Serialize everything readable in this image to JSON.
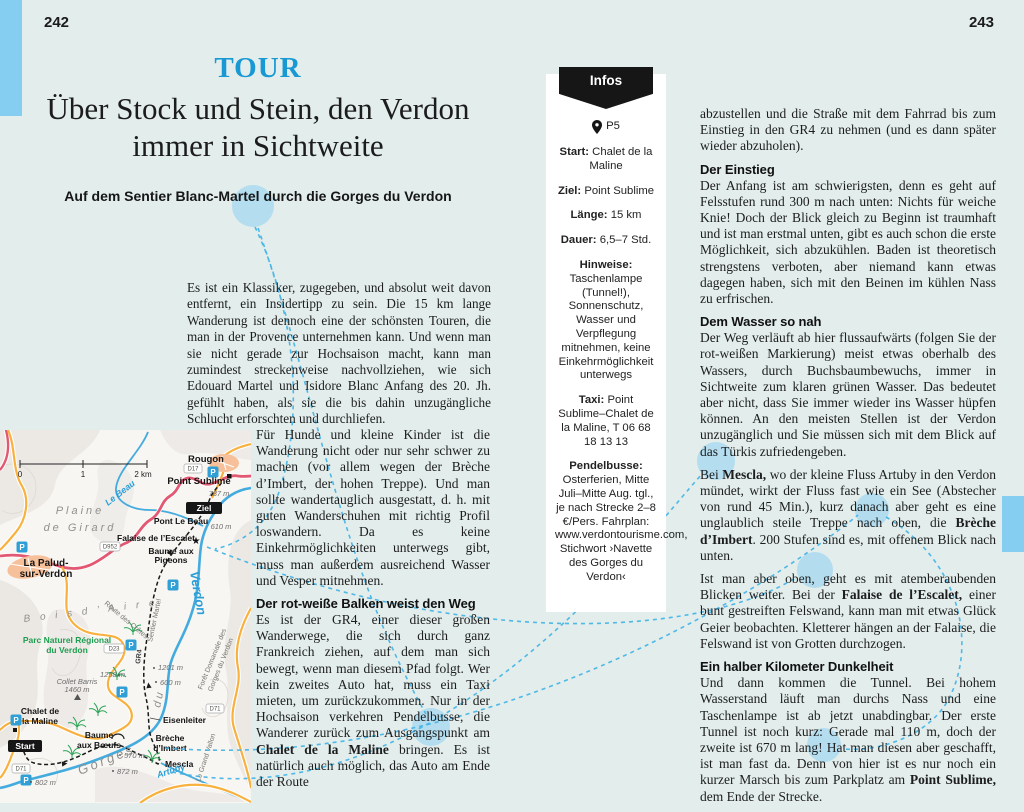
{
  "page": {
    "left_number": "242",
    "right_number": "243"
  },
  "colors": {
    "accent_blue": "#1899d4",
    "edge_bar_blue": "#85cef2",
    "highlight_blue": "#8ed0f2",
    "connector_blue": "#3fb3e6",
    "road_red": "#e25872",
    "road_yellow": "#f8b13f",
    "river_blue": "#44abde",
    "park_green": "#1e9e50",
    "village_orange": "#f6c09a"
  },
  "header": {
    "kicker": "TOUR",
    "title_line1": "Über Stock und Stein, den Verdon",
    "title_line2": "immer in Sichtweite",
    "subtitle": "Auf dem Sentier Blanc-Martel durch die Gorges du Verdon"
  },
  "left_column": {
    "para1": "Es ist ein Klassiker, zugegeben, und absolut weit davon entfernt, ein Insidertipp zu sein. Die 15 km lange Wanderung ist dennoch eine der schönsten Touren, die man in der Provence unternehmen kann. Und wenn man sie nicht gerade zur Hochsaison macht, kann man zumindest streckenweise nachvollziehen, wie sich Edouard Martel und Isidore Blanc Anfang des 20. Jh. gefühlt haben, als sie die bis dahin unzugängliche Schlucht erforschten und durchliefen.",
    "para2": "Für Hunde und kleine Kinder ist die Wanderung nicht oder nur sehr schwer zu machen (vor allem wegen der Brèche d’Imbert, der hohen Treppe). Und man sollte wandertauglich ausgestatt, d. h. mit guten Wanderschuhen mit richtig Profil loswandern. Da es keine Einkehrmöglichkeiten unterwegs gibt, muss man außerdem ausreichend Wasser und Vesper mitnehmen.",
    "heading1": "Der rot-weiße Balken weist den Weg",
    "para3_rich": [
      {
        "t": "Es ist der GR4, einer dieser großen Wanderwege, die sich durch ganz Frankreich ziehen, auf dem man sich bewegt, wenn man diesem Pfad folgt. Wer kein zweites Auto hat, muss ein Taxi mieten, um zurückzukommen. Nur in der Hochsaison verkehren Pendelbusse, die Wanderer zurück zum Ausgangspunkt am "
      },
      {
        "t": "Chalet de la Maline",
        "b": true
      },
      {
        "t": " bringen. Es ist natürlich auch möglich, das Auto am Ende der Route"
      }
    ]
  },
  "right_column": {
    "para0": "abzustellen und die Straße mit dem Fahrrad bis zum Einstieg in den GR4 zu nehmen (und es dann später wieder abzuholen).",
    "h1": "Der Einstieg",
    "p1": "Der Anfang ist am schwierigsten, denn es geht auf Felsstufen rund 300 m nach unten: Nichts für weiche Knie! Doch der Blick gleich zu Beginn ist traumhaft und ist man erstmal unten, gibt es auch schon die erste Möglichkeit, sich abzukühlen. Baden ist theoretisch strengstens verboten, aber niemand kann etwas dagegen haben, sich mit den Beinen im kühlen Nass zu erfrischen.",
    "h2": "Dem Wasser so nah",
    "p2": "Der Weg verläuft ab hier flussaufwärts (folgen Sie der rot-weißen Markierung) meist etwas oberhalb des Wassers, durch Buchsbaumbewuchs, immer in Sichtweite zum klaren grünen Wasser. Das bedeutet aber nicht, dass Sie immer wieder ins Wasser hüpfen können. An den meisten Stellen ist der Verdon unzugänglich und Sie müssen sich mit dem Blick auf das Türkis zufriedengeben.",
    "p3_rich": [
      {
        "t": "Bei "
      },
      {
        "t": "Mescla,",
        "b": true
      },
      {
        "t": " wo der kleine Fluss Artuby in den Verdon mündet, wirkt der Fluss fast wie ein See (Abstecher von rund 45 Min.), kurz danach aber geht es eine unglaublich steile Treppe nach oben, die "
      },
      {
        "t": "Brèche d’Imbert",
        "b": true
      },
      {
        "t": ". 200 Stufen sind es, mit offenem Blick nach unten."
      }
    ],
    "p4_rich": [
      {
        "t": "Ist man aber oben, geht es mit atemberaubenden Blicken weiter. Bei der "
      },
      {
        "t": "Falaise de l’Escalet,",
        "b": true
      },
      {
        "t": " einer bunt gestreiften Felswand, kann man mit etwas Glück Geier beobachten. Kletterer hängen an der Falaise, die Felswand ist von Grotten durchzogen."
      }
    ],
    "h3": "Ein halber Kilometer Dunkelheit",
    "p5_rich": [
      {
        "t": "Und dann kommen die Tunnel. Bei hohem Wasserstand läuft man durchs Nass und eine Taschenlampe ist ab jetzt unabdingbar. Der erste Tunnel ist noch kurz: Gerade mal 110 m, doch der zweite ist 670 m lang! Hat man diesen aber geschafft, ist man fast da. Denn von hier ist es nur noch ein kurzer Marsch bis zum Parkplatz am "
      },
      {
        "t": "Point Sublime,",
        "b": true
      },
      {
        "t": " dem Ende der Strecke."
      }
    ]
  },
  "infobox": {
    "title": "Infos",
    "location": "P5",
    "fields": [
      {
        "label": "Start:",
        "value": "Chalet de la Maline"
      },
      {
        "label": "Ziel:",
        "value": "Point Sublime"
      },
      {
        "label": "Länge:",
        "value": "15 km"
      },
      {
        "label": "Dauer:",
        "value": "6,5–7 Std."
      },
      {
        "label": "Hinweise:",
        "value": "Taschenlampe (Tunnel!), Sonnenschutz, Wasser und Verpflegung mitnehmen, keine Einkehrmöglichkeit unterwegs"
      },
      {
        "label": "Taxi:",
        "value": "Point Sublime–Chalet de la Maline, T 06 68 18 13 13"
      },
      {
        "label": "Pendelbusse:",
        "value": "Osterferien, Mitte Juli–Mitte Aug. tgl., je nach Strecke 2–8 €/Pers. Fahrplan: www.verdontourisme.com, Stichwort ›Navette des Gorges du Verdon‹"
      }
    ]
  },
  "map": {
    "labels": {
      "rougon": "Rougon",
      "point_sublime": "Point Sublime",
      "elev787": "787 m",
      "ziel": "Ziel",
      "pont_le_beau": "Pont Le Beau",
      "elev610": "610 m",
      "falaise": "Falaise de l’Escalet",
      "baume_pigeons1": "Baume aux",
      "baume_pigeons2": "Pigeons",
      "le_beau": "Le Beau",
      "plaine1": "Plaine",
      "plaine2": "de Girard",
      "la_palud1": "La Palud-",
      "la_palud2": "sur-Verdon",
      "bois": "B o i s   d ’ A i r e",
      "parc1": "Parc Naturel Régional",
      "parc2": "du Verdon",
      "collet1": "Collet Barris",
      "collet2": "1460 m",
      "elev1258": "1258 m",
      "elev1201": "1201 m",
      "elev600": "600 m",
      "elev570": "570 m",
      "elev872": "872 m",
      "elev802": "802 m",
      "chalet1": "Chalet de",
      "chalet2": "la Maline",
      "start": "Start",
      "baume_boeufs1": "Baume",
      "baume_boeufs2": "aux Bœufs",
      "eisenleiter": "Eisenleiter",
      "breche1": "Brèche",
      "breche2": "d’Imbert",
      "mescla": "Mescla",
      "grand_vallon": "Le Grand Vallon",
      "foret1": "Forêt Domaniale des",
      "foret2": "Gorges du Verdon",
      "gorges": "Gorges",
      "du": "du",
      "verdon": "Verdon",
      "artuby": "Artuby",
      "route_cretes": "Route des Crêtes",
      "sentier_martel": "Sentier Martel",
      "gr4": "GR4",
      "d952": "D952",
      "d23": "D23",
      "d17": "D17",
      "d71": "D71",
      "scale0": "0",
      "scale1": "1",
      "scale2": "2 km",
      "parking": "P",
      "star": "★"
    }
  }
}
